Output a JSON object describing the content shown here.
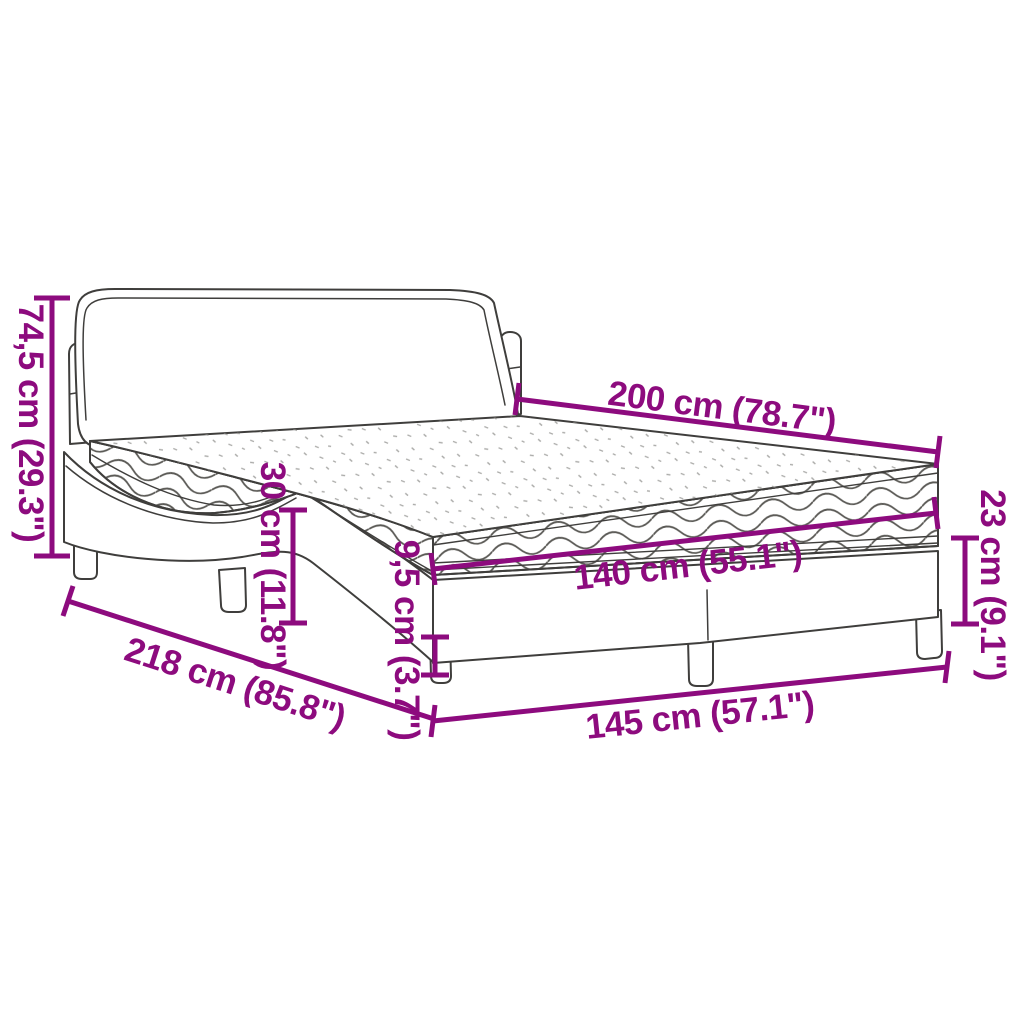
{
  "colors": {
    "accent": "#8d0b7e",
    "line": "#3f3e3c",
    "waves": "#5b5a56",
    "stipple": "#8f8f8c",
    "background": "#ffffff"
  },
  "diagram": {
    "type": "product-dimension-diagram",
    "subject": "bed-with-mattress",
    "dimensions": [
      {
        "id": "headboard-height",
        "label": "74,5 cm (29.3\")"
      },
      {
        "id": "mattress-length",
        "label": "200 cm (78.7\")"
      },
      {
        "id": "mattress-height",
        "label": "30 cm (11.8\")"
      },
      {
        "id": "rail-height",
        "label": "9,5 cm (3.7\")"
      },
      {
        "id": "mattress-width",
        "label": "140 cm (55.1\")"
      },
      {
        "id": "frame-height",
        "label": "23 cm (9.1\")"
      },
      {
        "id": "total-length",
        "label": "218 cm (85.8\")"
      },
      {
        "id": "total-width",
        "label": "145 cm (57.1\")"
      }
    ]
  }
}
